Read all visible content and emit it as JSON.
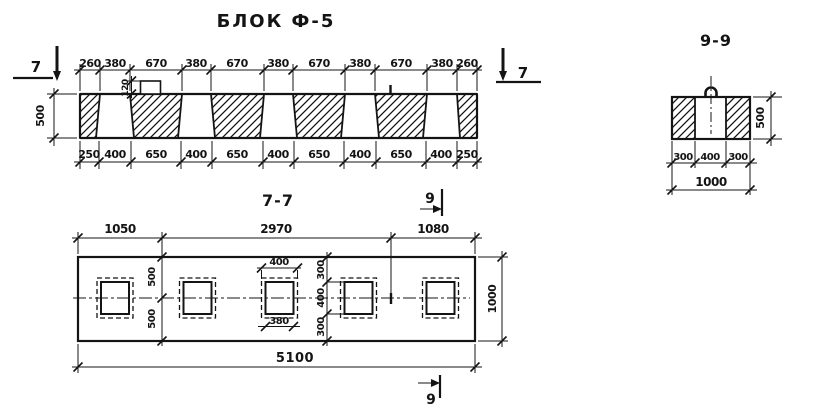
{
  "title": "БЛОК Ф-5",
  "colors": {
    "ink": "#141414",
    "paper": "#ffffff"
  },
  "elevation": {
    "section_mark_left": "7",
    "section_mark_right": "7",
    "top_dims": [
      "260",
      "380",
      "670",
      "380",
      "670",
      "380",
      "670",
      "380",
      "670",
      "380",
      "260"
    ],
    "bottom_dims": [
      "250",
      "400",
      "650",
      "400",
      "650",
      "400",
      "650",
      "400",
      "650",
      "400",
      "250"
    ],
    "height_dim": "500",
    "loop_height_dim": "120"
  },
  "plan": {
    "label": "7-7",
    "section_mark_top": "9",
    "section_mark_bottom": "9",
    "top_dims": [
      "1050",
      "2970",
      "1080"
    ],
    "total_length_dim": "5100",
    "width_dim": "1000",
    "half_width_dims": [
      "500",
      "500"
    ],
    "transverse_chain_dims": [
      "300",
      "400",
      "300"
    ],
    "socket_top_dim": "400",
    "socket_bottom_dim": "380"
  },
  "section_9_9": {
    "label": "9-9",
    "bottom_chain_dims": [
      "300",
      "400",
      "300"
    ],
    "total_width_dim": "1000",
    "height_dim": "500"
  }
}
